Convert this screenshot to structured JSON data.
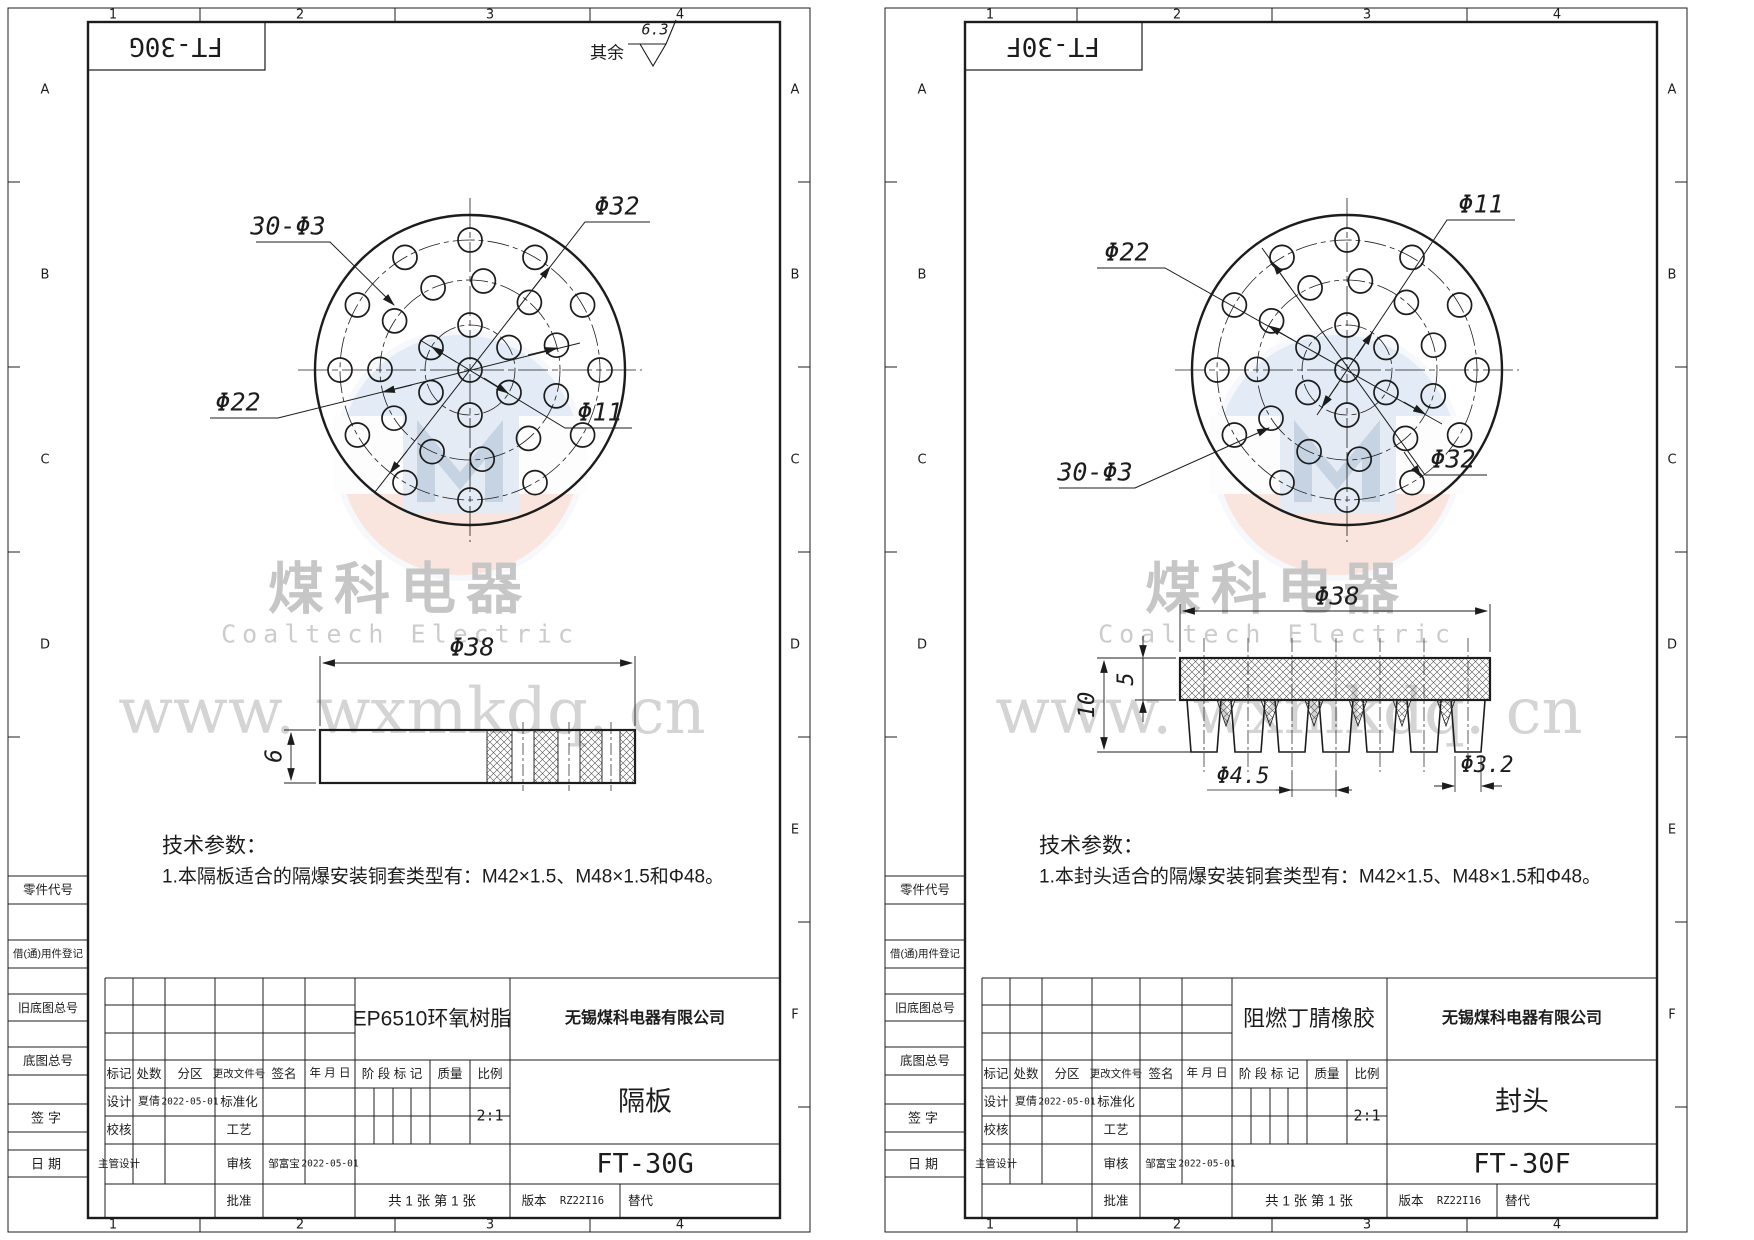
{
  "colors": {
    "line": "#1c1c1c",
    "watermark_text": "#c8c8c8",
    "logo_blue": "#c9dbee",
    "logo_red": "#f4cdbc",
    "logo_m": "#8fa8c8",
    "paper": "#ffffff"
  },
  "watermark": {
    "cn": "煤科电器",
    "en": "Coaltech Electric",
    "url": "www. wxmkdq. cn"
  },
  "zones": {
    "cols": [
      "1",
      "2",
      "3",
      "4"
    ],
    "rows": [
      "A",
      "B",
      "C",
      "D",
      "E",
      "F"
    ]
  },
  "drawing": {
    "outer_r": 155,
    "hole_r": 12,
    "rings": [
      {
        "r": 130,
        "count": 12,
        "start": 0
      },
      {
        "r": 90,
        "count": 11,
        "start": 16
      },
      {
        "r": 45,
        "count": 6,
        "start": 30
      }
    ],
    "teeth": {
      "count": 7,
      "pitch": 44,
      "x0": 327,
      "top_w": 34,
      "bottom_w": 26,
      "y": 700,
      "h": 52
    }
  },
  "sheets": [
    {
      "corner_code": "FT-30G",
      "surface_prefix": "其余",
      "surface_value": "6.3",
      "labels": {
        "tl": "30-Φ3",
        "tr": "Φ32",
        "bl": "Φ22",
        "br": "Φ11"
      },
      "dims": {
        "width": "Φ38",
        "height": "6"
      },
      "notes": {
        "title": "技术参数：",
        "item1": "1.本隔板适合的隔爆安装铜套类型有：M42×1.5、M48×1.5和Φ48。"
      },
      "margin_labels": [
        "零件代号",
        "借(通)用件登记",
        "旧底图总号",
        "底图总号",
        "签字",
        "日期"
      ],
      "tb": {
        "rev_h": [
          "标记",
          "处数",
          "分区",
          "更改文件号",
          "签名",
          "年 月 日"
        ],
        "r2": [
          "设计",
          "夏倩",
          "2022-05-01",
          "标准化"
        ],
        "r3": [
          "校核",
          "工艺"
        ],
        "r4": [
          "主管设计",
          "审核",
          "邹富宝",
          "2022-05-01"
        ],
        "r5": [
          "批准"
        ],
        "stage": [
          "阶 段 标 记",
          "质量",
          "比例"
        ],
        "scale": "2:1",
        "material": "EP6510环氧树脂",
        "company": "无锡煤科电器有限公司",
        "part_name": "隔板",
        "part_no": "FT-30G",
        "sheets_info": "共 1 张  第 1 张",
        "version_label": "版本",
        "version": "RZ22I16",
        "alt": "替代"
      }
    },
    {
      "corner_code": "FT-30F",
      "labels": {
        "tl": "Φ22",
        "tr": "Φ11",
        "bl": "30-Φ3",
        "br": "Φ32"
      },
      "dims": {
        "width": "Φ38",
        "total": "10",
        "band": "5",
        "pitch": "Φ4.5",
        "tip": "Φ3.2"
      },
      "notes": {
        "title": "技术参数：",
        "item1": "1.本封头适合的隔爆安装铜套类型有：M42×1.5、M48×1.5和Φ48。"
      },
      "margin_labels": [
        "零件代号",
        "借(通)用件登记",
        "旧底图总号",
        "底图总号",
        "签字",
        "日期"
      ],
      "tb": {
        "rev_h": [
          "标记",
          "处数",
          "分区",
          "更改文件号",
          "签名",
          "年 月 日"
        ],
        "r2": [
          "设计",
          "夏倩",
          "2022-05-01",
          "标准化"
        ],
        "r3": [
          "校核",
          "工艺"
        ],
        "r4": [
          "主管设计",
          "审核",
          "邹富宝",
          "2022-05-01"
        ],
        "r5": [
          "批准"
        ],
        "stage": [
          "阶 段 标 记",
          "质量",
          "比例"
        ],
        "scale": "2:1",
        "material": "阻燃丁腈橡胶",
        "company": "无锡煤科电器有限公司",
        "part_name": "封头",
        "part_no": "FT-30F",
        "sheets_info": "共 1 张  第 1 张",
        "version_label": "版本",
        "version": "RZ22I16",
        "alt": "替代"
      }
    }
  ]
}
